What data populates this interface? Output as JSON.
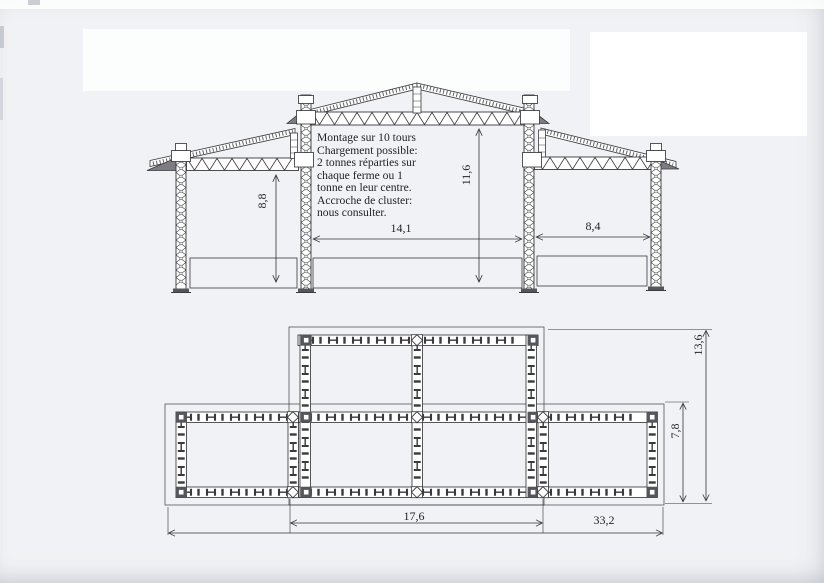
{
  "notes": {
    "lines": [
      "Montage sur 10 tours",
      "Chargement possible:",
      "2 tonnes réparties sur",
      "chaque ferme ou 1",
      "tonne en leur centre.",
      "Accroche de cluster:",
      "nous consulter."
    ]
  },
  "dimensions": {
    "elevation": {
      "left_bay_height": "8,8",
      "center_clear_height": "11,6",
      "center_span": "14,1",
      "right_span": "8,4"
    },
    "plan": {
      "total_depth": "13,6",
      "wing_depth": "7,8",
      "center_width": "17,6",
      "total_width": "33,2"
    }
  },
  "colors": {
    "ink": "#3a3a3e",
    "paper": "#f1f2f5",
    "patch": "#ffffff"
  }
}
